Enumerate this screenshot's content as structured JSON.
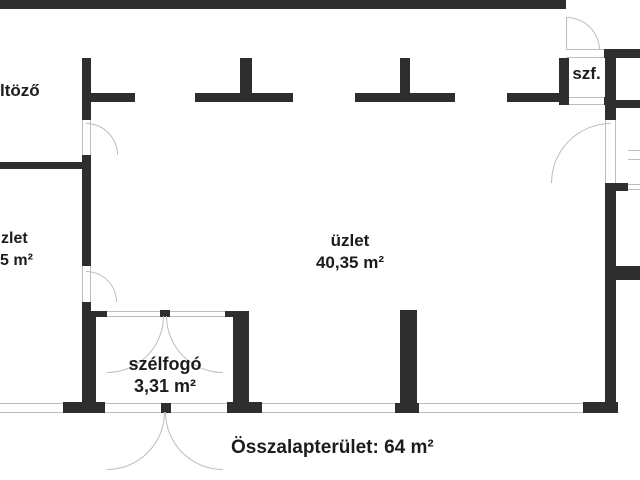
{
  "meta": {
    "kind": "floor-plan",
    "language": "hu"
  },
  "colors": {
    "bg": "#ffffff",
    "wall": "#2e2e2e",
    "line": "#bdbdbd",
    "text": "#1c1c1c"
  },
  "rooms": {
    "oltozo": {
      "label": "ltöző"
    },
    "uzlet_left": {
      "label": "zlet",
      "area": "5 m²"
    },
    "uzlet": {
      "label": "üzlet",
      "area": "40,35 m²"
    },
    "szf": {
      "label": "szf."
    },
    "szelfogo": {
      "label": "szélfogó",
      "area": "3,31 m²"
    }
  },
  "summary": {
    "total_area": "Összalapterület: 64 m²"
  }
}
